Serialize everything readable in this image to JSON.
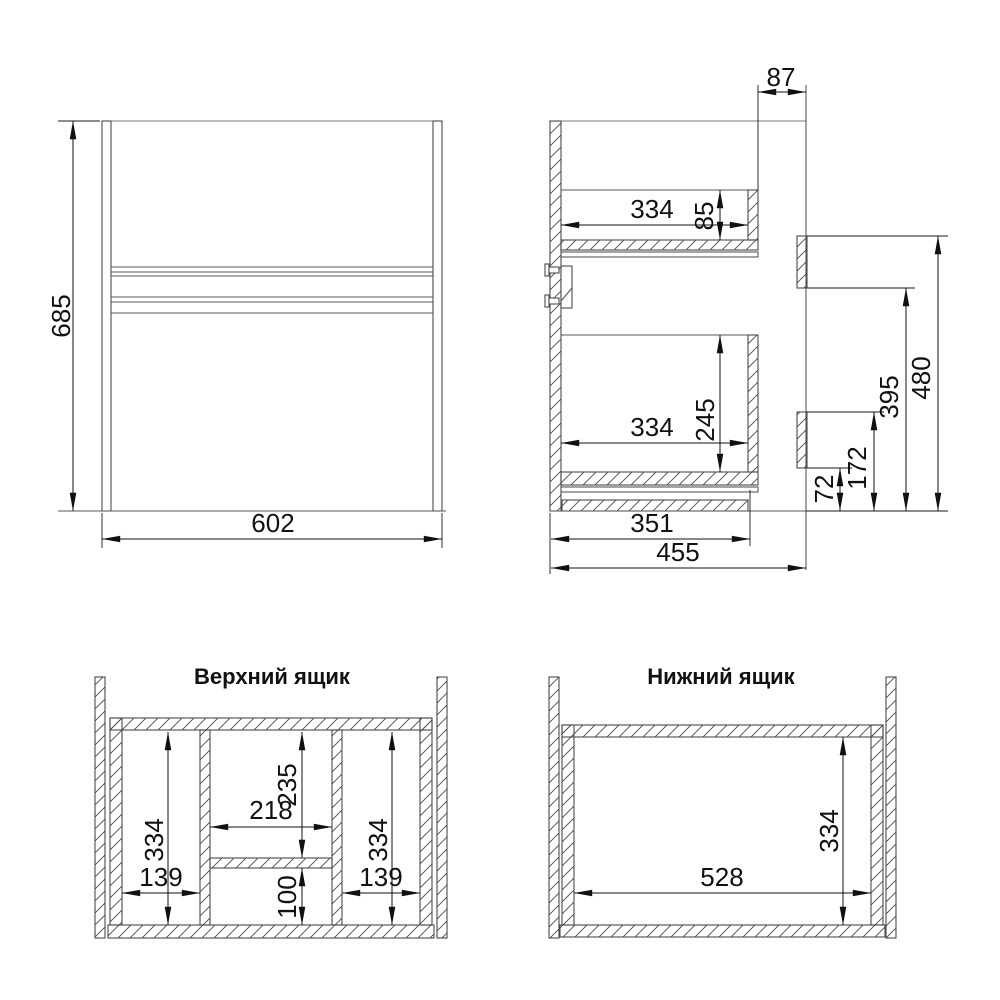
{
  "drawing": {
    "front_view": {
      "height": "685",
      "width": "602"
    },
    "side_view": {
      "back_gap": "87",
      "upper_drawer_inner_depth": "334",
      "upper_drawer_back_height": "85",
      "lower_drawer_inner_depth": "334",
      "lower_drawer_back_height": "245",
      "bottom_panel_depth": "351",
      "total_depth": "455",
      "lower_bracket_bottom_height": "72",
      "lower_bracket_top_height": "172",
      "upper_bracket_bottom_height": "395",
      "upper_bracket_top_height": "480"
    },
    "upper_drawer_view": {
      "title": "Верхний ящик",
      "left_section_depth": "334",
      "left_section_width": "139",
      "middle_back_depth": "235",
      "middle_width": "218",
      "middle_front_depth": "100",
      "right_section_depth": "334",
      "right_section_width": "139"
    },
    "lower_drawer_view": {
      "title": "Нижний ящик",
      "inner_width": "528",
      "inner_depth": "334"
    }
  },
  "colors": {
    "background": "#ffffff",
    "geometry_line": "#5a5a5a",
    "dimension_line": "#111111",
    "hatch": "#4a4a4a",
    "text": "#111111"
  }
}
